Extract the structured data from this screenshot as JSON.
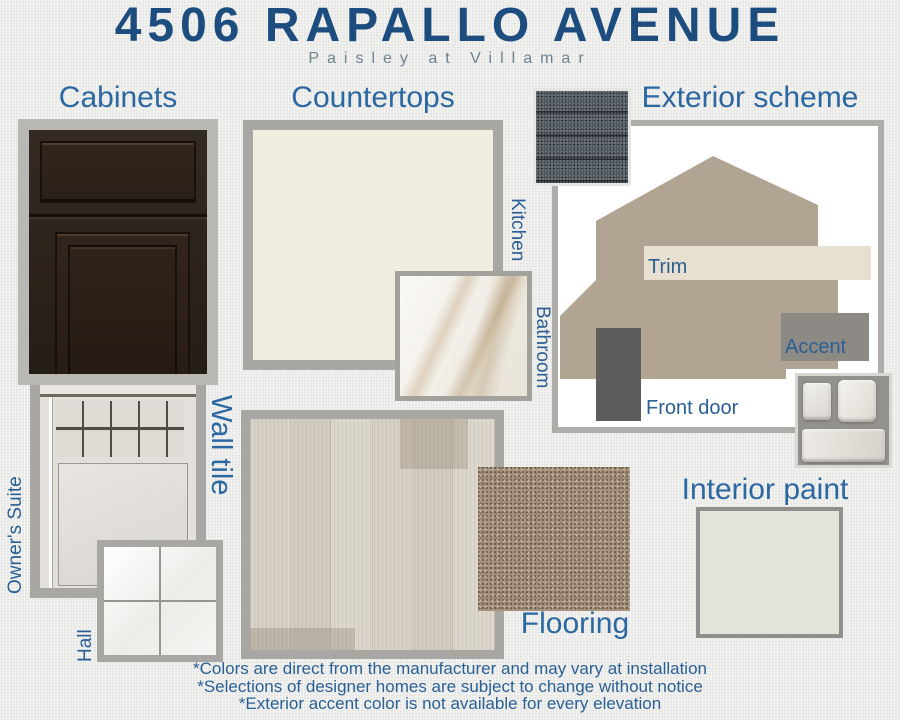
{
  "header": {
    "title": "4506 RAPALLO AVENUE",
    "subtitle": "Paisley at Villamar"
  },
  "cabinets": {
    "label": "Cabinets"
  },
  "countertops": {
    "label": "Countertops",
    "kitchen": "Kitchen",
    "bathroom": "Bathroom"
  },
  "exterior": {
    "label": "Exterior scheme",
    "trim": "Trim",
    "accent": "Accent",
    "front_door": "Front door"
  },
  "wall_tile": {
    "label": "Wall tile",
    "owners_suite": "Owner's Suite",
    "hall": "Hall"
  },
  "flooring": {
    "label": "Flooring"
  },
  "interior_paint": {
    "label": "Interior paint"
  },
  "footer": {
    "line1": "*Colors are direct from the manufacturer and may vary at installation",
    "line2": "*Selections of designer homes are subject to change without notice",
    "line3": "*Exterior accent color is not available for every elevation"
  },
  "palette": {
    "title_navy": "#1d4c7e",
    "label_blue": "#2b67a0",
    "subtitle_gray": "#6d8293",
    "frame_gray": "#a8a7a3",
    "cabinet_espresso": "#2b2119",
    "kitchen_counter_cream": "#f1edde",
    "house_taupe": "#b2a493",
    "trim_cream": "#e7dfcf",
    "accent_gray": "#8d8984",
    "front_door_gray": "#5f5d5b",
    "interior_paint_color": "#e4e3d9",
    "shingle_gray": "#4e555b",
    "carpet_taupe": "#a6947f"
  }
}
